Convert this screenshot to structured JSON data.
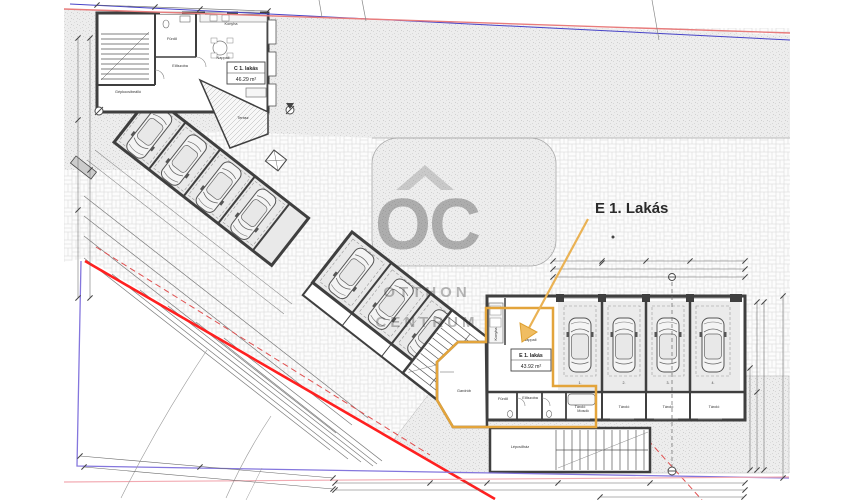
{
  "callout": {
    "label": "E 1. Lakás",
    "color": "#f2a31d"
  },
  "watermark": {
    "mark": "OC",
    "line1": "OTTHON",
    "line2": "CENTRUM"
  },
  "units": {
    "c1": {
      "name": "C 1. lakás",
      "area": "46.29 m²"
    },
    "e1": {
      "name": "E 1. lakás",
      "area": "43.92 m²"
    }
  },
  "rooms": {
    "furdo": "Fürdő",
    "konyha": "Konyha",
    "eloszoba": "Előszoba",
    "nappali": "Nappali",
    "gepkocsibeallo": "Gépkocsibeálló",
    "terasz": "Terasz",
    "gardrob": "Gardrób",
    "mosdo": "Mosdó",
    "lepcsohaz": "Lépcsőház",
    "tarolo": "Tároló"
  },
  "garage_bays": [
    "1.",
    "2.",
    "3.",
    "4."
  ],
  "colors": {
    "highlight": "#e3a43b",
    "boundary_red": "#ff2020",
    "boundary_purple": "#8476dd",
    "site_red": "#e87c7c",
    "site_blue": "#4743c8"
  }
}
